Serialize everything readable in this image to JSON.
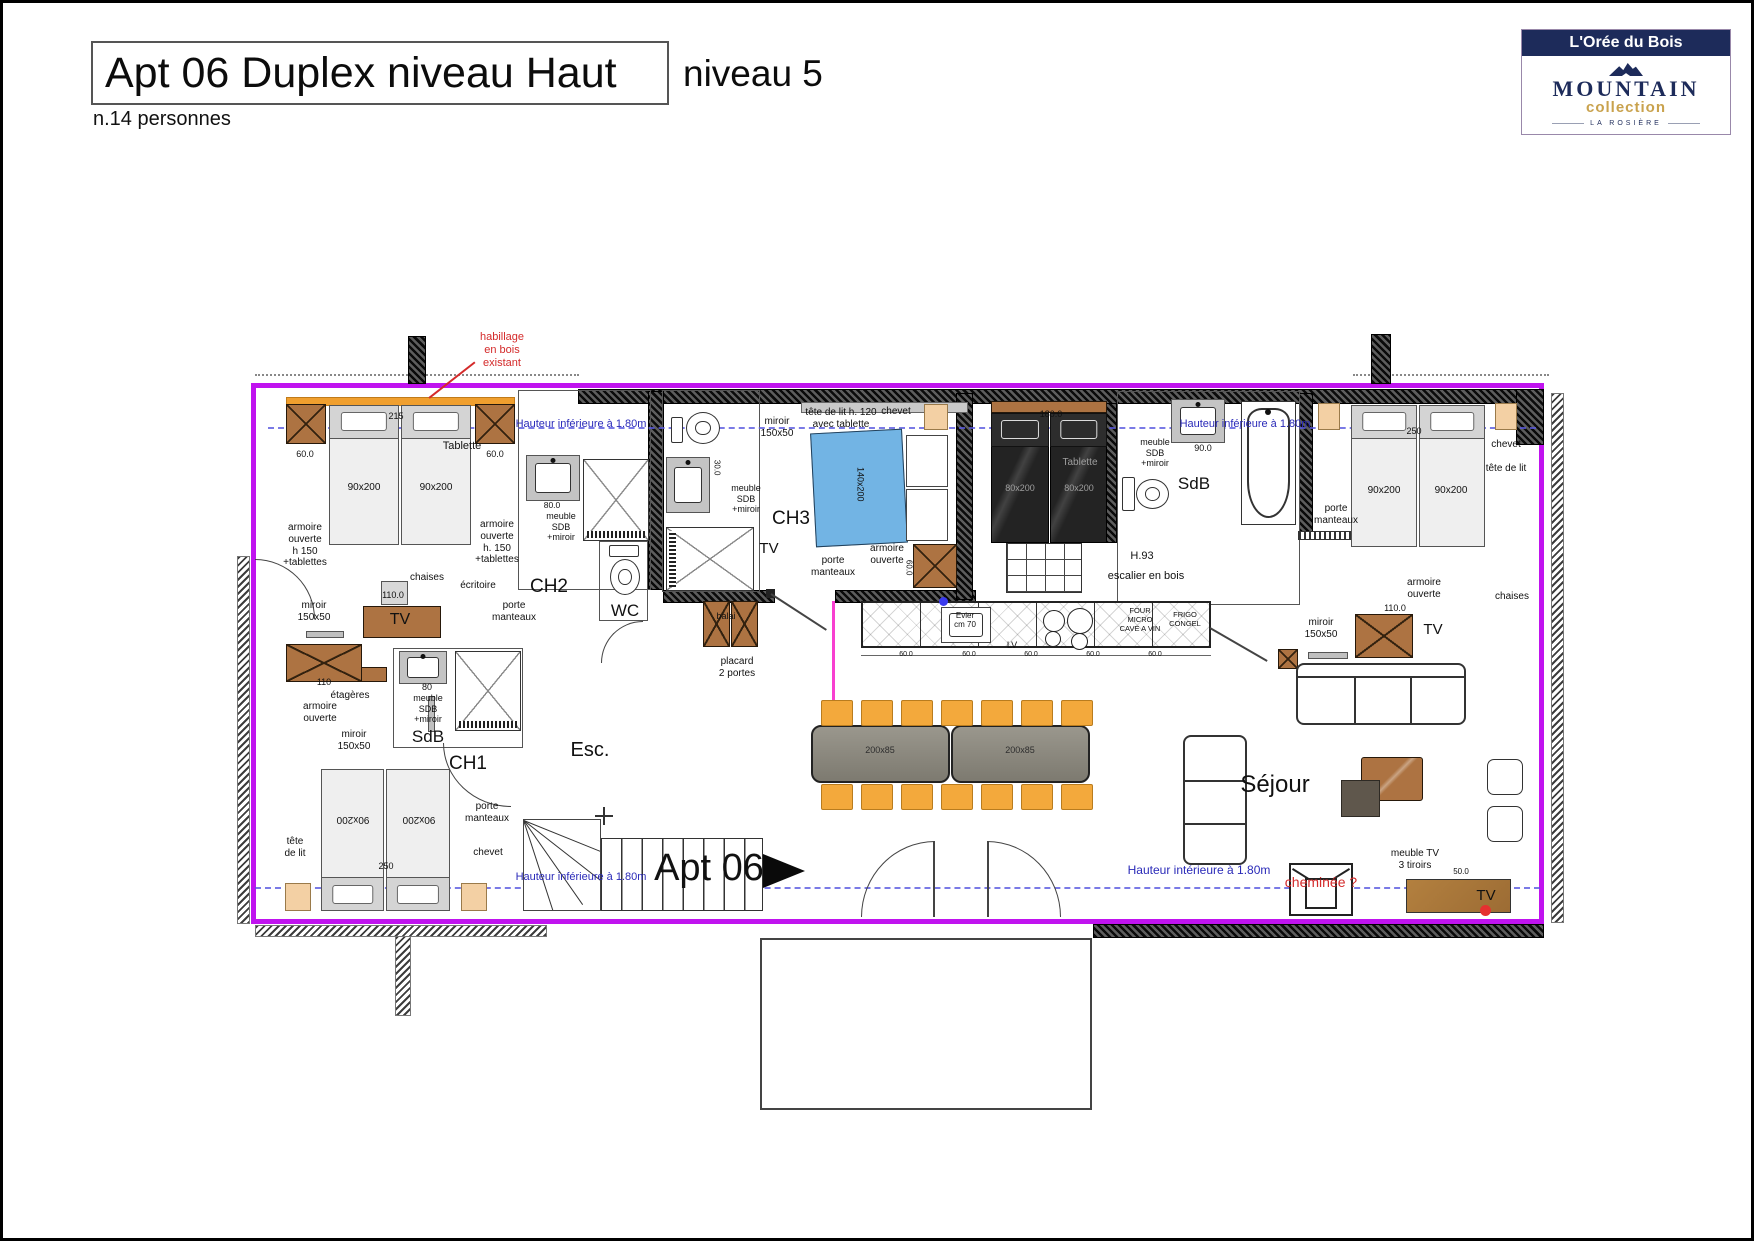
{
  "header": {
    "title": "Apt 06 Duplex niveau Haut",
    "level": "niveau 5",
    "capacity": "n.14 personnes"
  },
  "logo": {
    "residence": "L'Orée du Bois",
    "brand": "MOUNTAIN",
    "collection": "collection",
    "location": "LA ROSIÈRE"
  },
  "colors": {
    "boundary": "#c013ef",
    "wood_strip": "#f09f2e",
    "furniture_brown": "#ad7342",
    "chevet_beige": "#f3d0a4",
    "bed_blue": "#72b4e4",
    "table_gray": "#8e8b82",
    "chair_orange": "#f3a93c",
    "annotation_blue": "#2a2ab8",
    "annotation_red": "#d42a2a"
  },
  "plan": {
    "labels": [
      {
        "t": "habillage\nen bois\nexistant",
        "x": 499,
        "y": 328,
        "s": 11,
        "c": "red",
        "n": "note-habillage"
      },
      {
        "t": "Hauteur inférieure à 1.80m",
        "x": 578,
        "y": 415,
        "s": 11,
        "c": "blue",
        "n": "height-note"
      },
      {
        "t": "Hauteur inférieure à 1.80m",
        "x": 1242,
        "y": 415,
        "s": 11,
        "c": "blue",
        "n": "height-note"
      },
      {
        "t": "Hauteur inférieure à 1.80m",
        "x": 578,
        "y": 868,
        "s": 11,
        "c": "blue",
        "n": "height-note"
      },
      {
        "t": "Hauteur intérieure à 1.80m",
        "x": 1196,
        "y": 860,
        "s": 12,
        "c": "blue",
        "n": "height-note"
      },
      {
        "t": "215",
        "x": 393,
        "y": 408,
        "s": 9
      },
      {
        "t": "60.0",
        "x": 302,
        "y": 446,
        "s": 9
      },
      {
        "t": "60.0",
        "x": 492,
        "y": 446,
        "s": 9
      },
      {
        "t": "Tablette",
        "x": 459,
        "y": 437,
        "s": 11
      },
      {
        "t": "armoire\nouverte\nh 150\n+tablettes",
        "x": 302,
        "y": 519,
        "s": 10
      },
      {
        "t": "armoire\nouverte\nh. 150\n+tablettes",
        "x": 494,
        "y": 516,
        "s": 10
      },
      {
        "t": "90x200",
        "x": 361,
        "y": 479,
        "s": 10
      },
      {
        "t": "90x200",
        "x": 433,
        "y": 479,
        "s": 10
      },
      {
        "t": "chaises",
        "x": 424,
        "y": 569,
        "s": 10
      },
      {
        "t": "110.0",
        "x": 390,
        "y": 587,
        "s": 9
      },
      {
        "t": "écritoire",
        "x": 475,
        "y": 577,
        "s": 10
      },
      {
        "t": "miroir\n150x50",
        "x": 311,
        "y": 597,
        "s": 10
      },
      {
        "t": "TV",
        "x": 397,
        "y": 608,
        "s": 16,
        "n": "tv-label"
      },
      {
        "t": "porte\nmanteaux",
        "x": 511,
        "y": 597,
        "s": 10
      },
      {
        "t": "CH2",
        "x": 546,
        "y": 573,
        "s": 19,
        "n": "room-ch2"
      },
      {
        "t": "meuble\nSDB\n+miroir",
        "x": 558,
        "y": 508,
        "s": 9
      },
      {
        "t": "80.0",
        "x": 549,
        "y": 497,
        "s": 8.5
      },
      {
        "t": "WC",
        "x": 622,
        "y": 598,
        "s": 17,
        "n": "room-wc"
      },
      {
        "t": "miroir\n150x50",
        "x": 774,
        "y": 413,
        "s": 10
      },
      {
        "t": "tête de lit h. 120\navec tablette",
        "x": 838,
        "y": 404,
        "s": 10
      },
      {
        "t": "chevet",
        "x": 893,
        "y": 403,
        "s": 10
      },
      {
        "t": "140x200",
        "x": 857,
        "y": 476,
        "s": 9,
        "r": 90
      },
      {
        "t": "meuble\nSDB\n+miroir",
        "x": 743,
        "y": 480,
        "s": 9
      },
      {
        "t": "30.0",
        "x": 714,
        "y": 460,
        "s": 8,
        "r": 90
      },
      {
        "t": "CH3",
        "x": 788,
        "y": 505,
        "s": 19,
        "n": "room-ch3"
      },
      {
        "t": "TV",
        "x": 766,
        "y": 537,
        "s": 15,
        "n": "tv-label"
      },
      {
        "t": "porte\nmanteaux",
        "x": 830,
        "y": 552,
        "s": 10
      },
      {
        "t": "armoire\nouverte",
        "x": 884,
        "y": 540,
        "s": 10
      },
      {
        "t": "60.0",
        "x": 906,
        "y": 560,
        "s": 8,
        "r": 90
      },
      {
        "t": "balai",
        "x": 723,
        "y": 608,
        "s": 9
      },
      {
        "t": "placard\n2 portes",
        "x": 734,
        "y": 653,
        "s": 10
      },
      {
        "t": "Tablette",
        "x": 1077,
        "y": 454,
        "s": 10,
        "c": "gray"
      },
      {
        "t": "80x200",
        "x": 1017,
        "y": 480,
        "s": 9,
        "c": "gray"
      },
      {
        "t": "80x200",
        "x": 1076,
        "y": 480,
        "s": 9,
        "c": "gray"
      },
      {
        "t": "180.0",
        "x": 1048,
        "y": 406,
        "s": 9
      },
      {
        "t": "H.93",
        "x": 1139,
        "y": 547,
        "s": 11
      },
      {
        "t": "escalier en bois",
        "x": 1143,
        "y": 567,
        "s": 11
      },
      {
        "t": "meuble\nSDB\n+miroir",
        "x": 1152,
        "y": 434,
        "s": 9
      },
      {
        "t": "90.0",
        "x": 1200,
        "y": 440,
        "s": 9
      },
      {
        "t": "SdB",
        "x": 1191,
        "y": 471,
        "s": 17,
        "n": "room-sdb"
      },
      {
        "t": "porte\nmanteaux",
        "x": 1333,
        "y": 500,
        "s": 10
      },
      {
        "t": "chevet",
        "x": 1503,
        "y": 436,
        "s": 10
      },
      {
        "t": "tête de lit",
        "x": 1503,
        "y": 460,
        "s": 10
      },
      {
        "t": "250",
        "x": 1411,
        "y": 423,
        "s": 9
      },
      {
        "t": "90x200",
        "x": 1381,
        "y": 482,
        "s": 10
      },
      {
        "t": "90x200",
        "x": 1448,
        "y": 482,
        "s": 10
      },
      {
        "t": "armoire\nouverte",
        "x": 1421,
        "y": 574,
        "s": 10
      },
      {
        "t": "chaises",
        "x": 1509,
        "y": 588,
        "s": 10
      },
      {
        "t": "110.0",
        "x": 1392,
        "y": 600,
        "s": 9
      },
      {
        "t": "miroir\n150x50",
        "x": 1318,
        "y": 614,
        "s": 10
      },
      {
        "t": "TV",
        "x": 1430,
        "y": 618,
        "s": 15,
        "n": "tv-label"
      },
      {
        "t": "Evier\ncm 70",
        "x": 962,
        "y": 608,
        "s": 8
      },
      {
        "t": "LV",
        "x": 1009,
        "y": 637,
        "s": 9
      },
      {
        "t": "FOUR\nMICRO\nCAVE A VIN",
        "x": 1137,
        "y": 604,
        "s": 7.5
      },
      {
        "t": "FRIGO\nCONGEL",
        "x": 1182,
        "y": 608,
        "s": 7.5
      },
      {
        "t": "60.0",
        "x": 903,
        "y": 648,
        "s": 7
      },
      {
        "t": "60.0",
        "x": 966,
        "y": 648,
        "s": 7
      },
      {
        "t": "60.0",
        "x": 1028,
        "y": 648,
        "s": 7
      },
      {
        "t": "60.0",
        "x": 1090,
        "y": 648,
        "s": 7
      },
      {
        "t": "60.0",
        "x": 1152,
        "y": 648,
        "s": 7
      },
      {
        "t": "200x85",
        "x": 877,
        "y": 742,
        "s": 9,
        "c": "dk"
      },
      {
        "t": "200x85",
        "x": 1017,
        "y": 742,
        "s": 9,
        "c": "dk"
      },
      {
        "t": "Séjour",
        "x": 1272,
        "y": 768,
        "s": 24,
        "n": "room-sejour"
      },
      {
        "t": "cheminée ?",
        "x": 1318,
        "y": 871,
        "s": 14,
        "c": "red",
        "n": "note-cheminee"
      },
      {
        "t": "meuble TV\n3 tiroirs",
        "x": 1412,
        "y": 845,
        "s": 10
      },
      {
        "t": "50.0",
        "x": 1458,
        "y": 864,
        "s": 8
      },
      {
        "t": "TV",
        "x": 1483,
        "y": 884,
        "s": 15,
        "n": "tv-label"
      },
      {
        "t": "Esc.",
        "x": 587,
        "y": 736,
        "s": 20,
        "n": "room-esc"
      },
      {
        "t": "Apt 06",
        "x": 706,
        "y": 843,
        "s": 38,
        "n": "apt-label"
      },
      {
        "t": "CH1",
        "x": 465,
        "y": 750,
        "s": 19,
        "n": "room-ch1"
      },
      {
        "t": "armoire\nouverte",
        "x": 317,
        "y": 698,
        "s": 10
      },
      {
        "t": "110",
        "x": 321,
        "y": 674,
        "s": 9
      },
      {
        "t": "étagères",
        "x": 347,
        "y": 687,
        "s": 10
      },
      {
        "t": "miroir\n150x50",
        "x": 351,
        "y": 726,
        "s": 10
      },
      {
        "t": "80",
        "x": 424,
        "y": 679,
        "s": 9
      },
      {
        "t": "meuble\nSDB\n+miroir",
        "x": 425,
        "y": 690,
        "s": 9
      },
      {
        "t": "SdB",
        "x": 425,
        "y": 724,
        "s": 17,
        "n": "room-sdb"
      },
      {
        "t": "90x200",
        "x": 350,
        "y": 810,
        "s": 10,
        "r": 180
      },
      {
        "t": "90x200",
        "x": 416,
        "y": 810,
        "s": 10,
        "r": 180
      },
      {
        "t": "tête\nde lit",
        "x": 292,
        "y": 833,
        "s": 10
      },
      {
        "t": "porte\nmanteaux",
        "x": 484,
        "y": 798,
        "s": 10
      },
      {
        "t": "chevet",
        "x": 485,
        "y": 844,
        "s": 10
      },
      {
        "t": "250",
        "x": 383,
        "y": 858,
        "s": 9
      }
    ]
  }
}
